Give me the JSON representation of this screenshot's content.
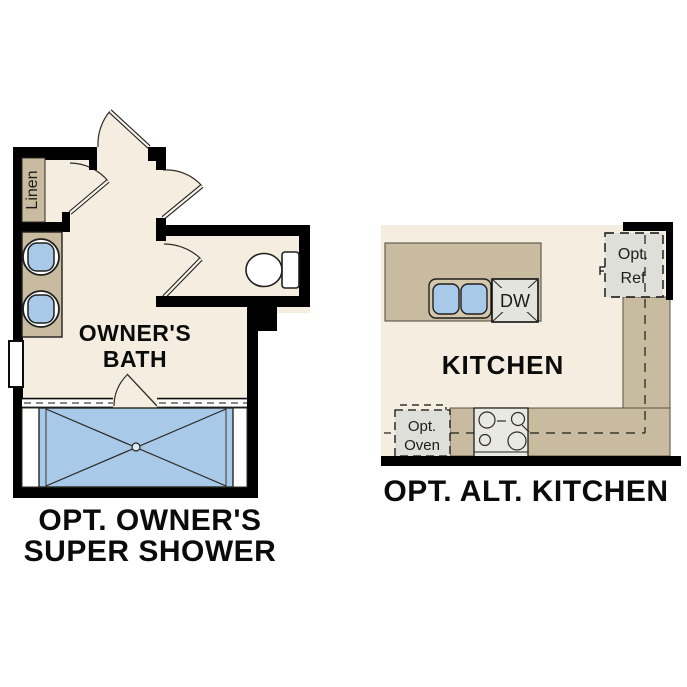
{
  "bath_plan": {
    "linen_label": "Linen",
    "room_label_line1": "OWNER'S",
    "room_label_line2": "BATH",
    "title_line1": "OPT. OWNER'S",
    "title_line2": "SUPER SHOWER"
  },
  "kitchen_plan": {
    "room_label": "KITCHEN",
    "dishwasher_label": "DW",
    "ref_label_line1": "Opt.",
    "ref_label_line2": "Ref",
    "oven_label_line1": "Opt.",
    "oven_label_line2": "Oven",
    "title": "OPT. ALT. KITCHEN"
  },
  "colors": {
    "floor_cream": "#f5eee0",
    "counter_tan": "#c9bb9f",
    "counter_tan_light": "#d5c8ad",
    "fixture_blue": "#a9c9e8",
    "drain_blue_light": "#dce9f7",
    "appliance_gray": "#e4e4de",
    "optional_gray": "#dedfd9",
    "wall_black": "#000000",
    "line_dark": "#2e2c24"
  }
}
